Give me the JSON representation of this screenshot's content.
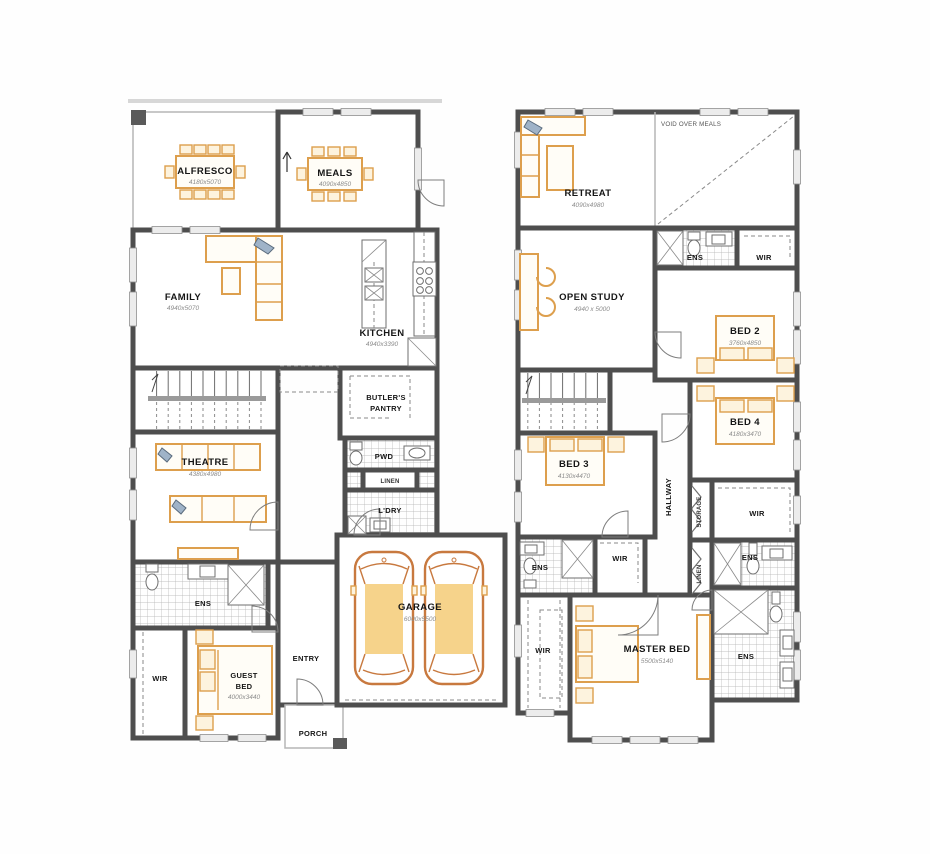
{
  "plan_title": "Two storey house floor plan",
  "colors": {
    "wall": "#4e4e4e",
    "furniture_orange": "#dd9f4d",
    "car_fill": "#f6d38b",
    "hatch_line": "#b0b0b0",
    "label_text": "#161616",
    "dimension_text": "#8b8b8b"
  },
  "ground": {
    "alfresco": {
      "label": "ALFRESCO",
      "dim": "4180x5070"
    },
    "meals": {
      "label": "MEALS",
      "dim": "4090x4850"
    },
    "family": {
      "label": "FAMILY",
      "dim": "4940x5070"
    },
    "kitchen": {
      "label": "KITCHEN",
      "dim": "4940x3390"
    },
    "butlers_pantry": {
      "line1": "BUTLER'S",
      "line2": "PANTRY"
    },
    "pwd": {
      "label": "PWD"
    },
    "linen": {
      "label": "LINEN"
    },
    "laundry": {
      "label": "L'DRY"
    },
    "theatre": {
      "label": "THEATRE",
      "dim": "4380x4980"
    },
    "ens": {
      "label": "ENS"
    },
    "wir": {
      "label": "WIR"
    },
    "guest_bed": {
      "line1": "GUEST",
      "line2": "BED",
      "dim": "4000x3440"
    },
    "entry": {
      "label": "ENTRY"
    },
    "porch": {
      "label": "PORCH"
    },
    "garage": {
      "label": "GARAGE",
      "dim": "6000x5500"
    }
  },
  "first": {
    "retreat": {
      "label": "RETREAT",
      "dim": "4090x4980"
    },
    "void_over_meals": {
      "label": "VOID OVER MEALS"
    },
    "ens_bed2": {
      "label": "ENS"
    },
    "wir_bed2": {
      "label": "WIR"
    },
    "open_study": {
      "label": "OPEN STUDY",
      "dim": "4940 x 5000"
    },
    "bed2": {
      "label": "BED 2",
      "dim": "3760x4850"
    },
    "bed4": {
      "label": "BED 4",
      "dim": "4180x3470"
    },
    "bed3": {
      "label": "BED 3",
      "dim": "4130x4470"
    },
    "hallway": {
      "label": "HALLWAY"
    },
    "storage": {
      "label": "STORAGE"
    },
    "linen": {
      "label": "LINEN"
    },
    "wir_bed4": {
      "label": "WIR"
    },
    "ens_bed3": {
      "label": "ENS"
    },
    "wir_bed3": {
      "label": "WIR"
    },
    "ens_bed4": {
      "label": "ENS"
    },
    "master_bed": {
      "label": "MASTER BED",
      "dim": "5500x5140"
    },
    "wir_master": {
      "label": "WIR"
    },
    "ens_master": {
      "label": "ENS"
    }
  }
}
